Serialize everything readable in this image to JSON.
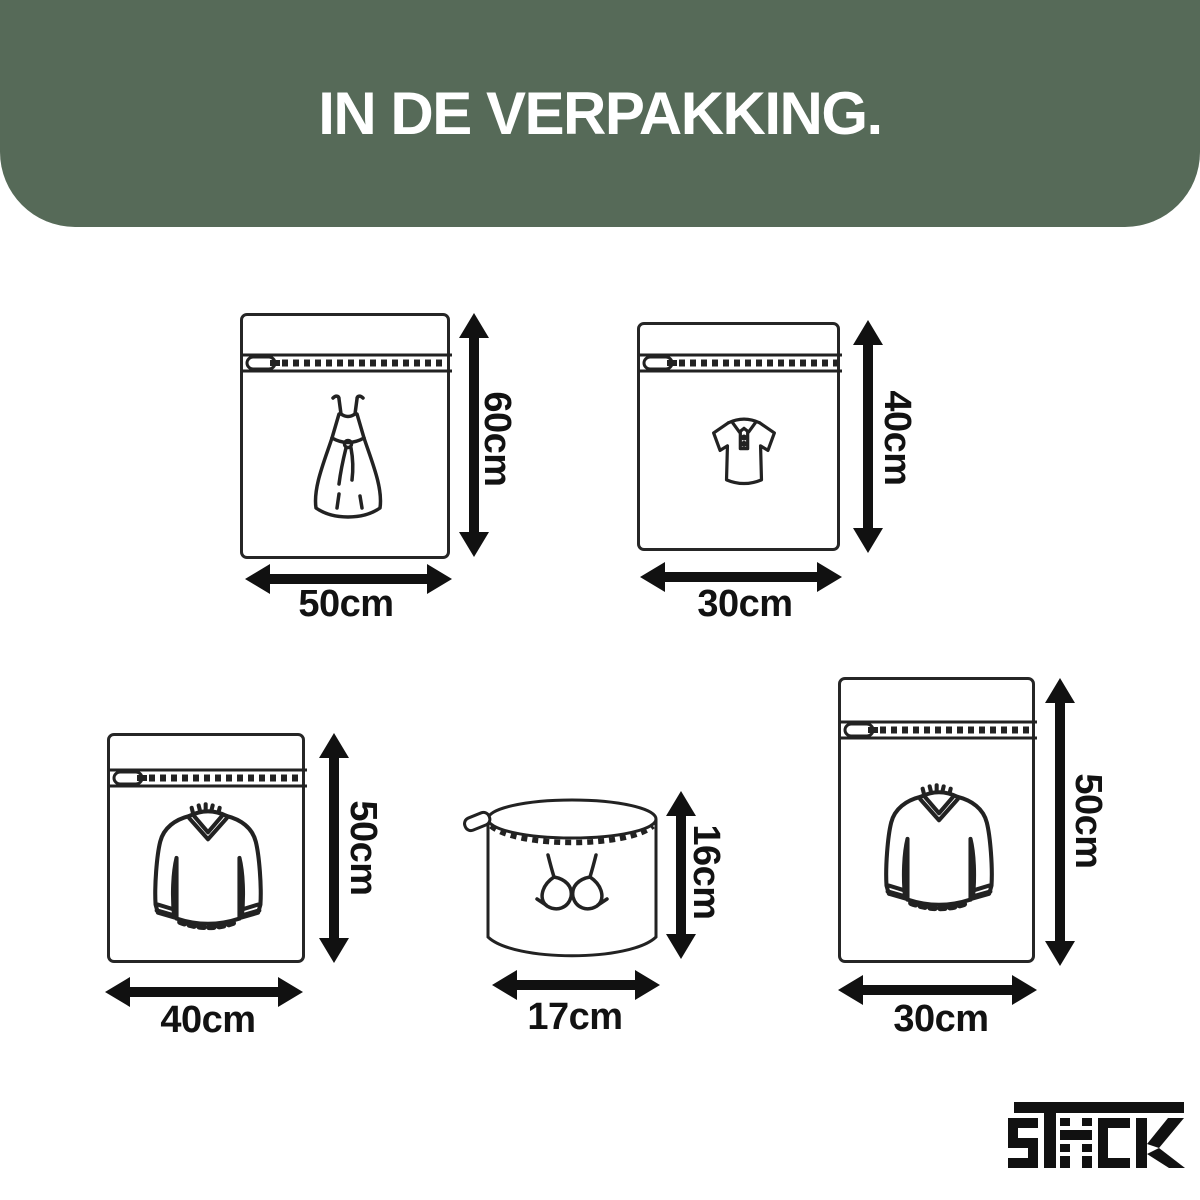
{
  "header": {
    "title": "IN DE VERPAKKING.",
    "bg_color": "#566a58",
    "text_color": "#ffffff"
  },
  "bags": [
    {
      "id": "dress-bag",
      "item": "dress",
      "height_label": "60cm",
      "width_label": "50cm"
    },
    {
      "id": "polo-bag",
      "item": "polo-shirt",
      "height_label": "40cm",
      "width_label": "30cm"
    },
    {
      "id": "sweater-bag-40",
      "item": "sweater",
      "height_label": "50cm",
      "width_label": "40cm"
    },
    {
      "id": "bra-bag",
      "item": "bra",
      "height_label": "16cm",
      "width_label": "17cm"
    },
    {
      "id": "sweater-bag-30",
      "item": "sweater",
      "height_label": "50cm",
      "width_label": "30cm"
    }
  ],
  "brand": {
    "name": "STACK"
  },
  "colors": {
    "header_bg": "#566a58",
    "line": "#222222",
    "arrow": "#111111",
    "label_text": "#121212"
  }
}
